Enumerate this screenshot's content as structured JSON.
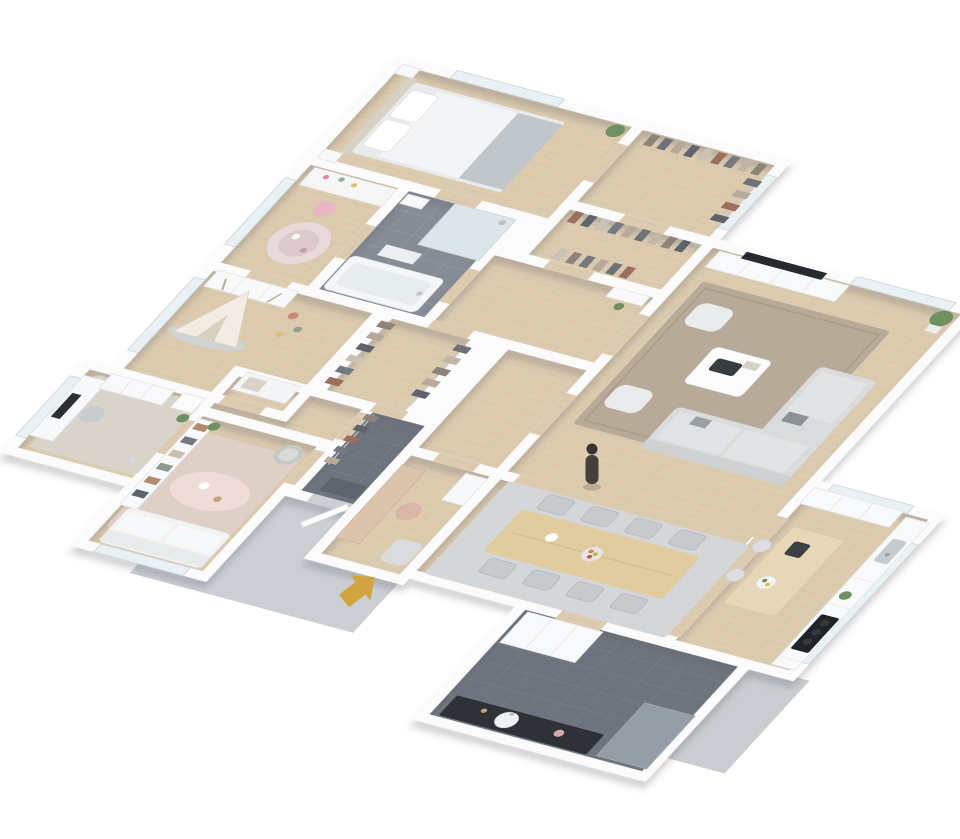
{
  "scene": {
    "description": "isometric-3d-floor-plan-render-of-furnished-apartment",
    "projection": "oblique-top-down",
    "background": "#ffffff"
  },
  "palette": {
    "wall": "#fbfbfc",
    "wood_floor": "#dccbaf",
    "tile_mid": "#868c95",
    "tile_dark": "#6e747d",
    "apron_concrete": "#cbcfd3",
    "apron_concrete_2": "#c9ccd0",
    "arrow_gold": "#d2a440",
    "person": "#44403b",
    "living_rug": "#b8aa98",
    "dining_rug": "#d4d6d8",
    "lounge_rug": "#ded0c6",
    "office_rug": "#d9d4ca",
    "dining_table_wood": "#e1cc9f",
    "island_top_wood": "#e6d7b8",
    "vanity_black": "#2e3236",
    "cooktop_black": "#202428",
    "sofa_gray": "#d9dbdc",
    "lounge_sofa_white": "#f2f3f4",
    "plant_green": "#6f9060"
  },
  "entrance": {
    "marker": "gold-block-arrow",
    "points_toward": "front-door-of-entry-hall"
  },
  "person": {
    "present": true,
    "location": "standing-between-living-room-and-dining-area"
  },
  "rooms": [
    {
      "id": "master-bedroom",
      "floor": "wood",
      "furniture": [
        "double-bed-white-duvet-gray-throw",
        "headboard",
        "two-pillows",
        "two-nightstands",
        "potted-plant"
      ]
    },
    {
      "id": "walk-in-closet",
      "floor": "wood",
      "furniture": [
        "long-clothes-rack",
        "side-clothes-rack"
      ]
    },
    {
      "id": "kids-study-nook",
      "floor": "wood",
      "furniture": [
        "desk-with-hutch",
        "pink-chair",
        "round-pink-rug"
      ]
    },
    {
      "id": "bathroom",
      "floor": "gray-tile",
      "furniture": [
        "bathtub",
        "walk-in-shower",
        "wall-sink",
        "bath-mat"
      ]
    },
    {
      "id": "dressing-corridor",
      "floor": "wood",
      "furniture": [
        "two-clothes-racks"
      ]
    },
    {
      "id": "hallway",
      "floor": "wood",
      "furniture": [
        "console",
        "plant"
      ]
    },
    {
      "id": "kids-room",
      "floor": "wood",
      "furniture": [
        "play-teepee",
        "gray-mat",
        "wardrobe",
        "toys",
        "bench"
      ]
    },
    {
      "id": "closet-corridor",
      "floor": "wood",
      "furniture": [
        "two-clothes-racks"
      ]
    },
    {
      "id": "home-office",
      "floor": "wood",
      "furniture": [
        "desk-with-monitor",
        "office-chair",
        "cabinet-row",
        "dresser",
        "plant",
        "rug"
      ]
    },
    {
      "id": "family-lounge",
      "floor": "wood",
      "furniture": [
        "white-sofa",
        "oval-coffee-table",
        "rattan-armchair",
        "bookshelf",
        "rug",
        "plant"
      ]
    },
    {
      "id": "entry-hall",
      "floor": "dark-tile",
      "furniture": [
        "coat-rack",
        "doormat",
        "front-door"
      ]
    },
    {
      "id": "study-dressing-room",
      "floor": "wood",
      "furniture": [
        "dressing-table",
        "chair",
        "armchair",
        "shelf"
      ]
    },
    {
      "id": "living-room",
      "floor": "wood",
      "furniture": [
        "l-shaped-gray-sofa",
        "chaise",
        "two-armchairs",
        "coffee-table-with-tray",
        "tv-sideboard",
        "wall-tv",
        "area-rug",
        "potted-plant"
      ]
    },
    {
      "id": "dining-area",
      "floor": "wood",
      "furniture": [
        "eight-seat-wood-table",
        "eight-chairs",
        "fruit-bowl",
        "area-rug"
      ]
    },
    {
      "id": "kitchen",
      "floor": "wood",
      "furniture": [
        "island-wood-top",
        "stand-mixer",
        "two-bar-stools",
        "counter-with-sink",
        "induction-cooktop",
        "tall-cabinets",
        "plant"
      ]
    },
    {
      "id": "guest-bathroom",
      "floor": "dark-tile",
      "furniture": [
        "black-vanity-round-basin",
        "walk-in-shower",
        "storage-closets"
      ]
    }
  ],
  "windows": [
    "master-bedroom-top",
    "closet-right",
    "study-nook-left",
    "kids-room-left",
    "office-left",
    "lounge-bottom",
    "living-room-top",
    "kitchen-top",
    "kitchen-right"
  ],
  "clothes_colors": [
    "#8d8478",
    "#6e7277",
    "#b7aa9b",
    "#5f646b",
    "#c9c2b6",
    "#9b6f5e",
    "#757a82",
    "#c2b6a8"
  ]
}
